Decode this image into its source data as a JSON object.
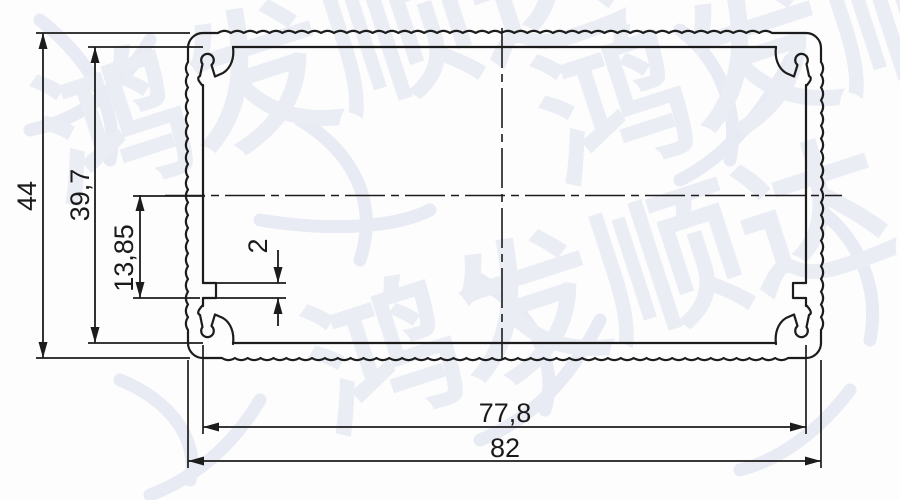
{
  "drawing": {
    "type": "extrusion-profile-cross-section",
    "line_color": "#1c1c1c",
    "background_color": "#fdfdfe"
  },
  "watermark": {
    "text": "鸿发顺达",
    "color": "#eaedf4"
  },
  "dimensions": {
    "outer_height": {
      "label": "44",
      "orientation": "vertical"
    },
    "inner_height": {
      "label": "39,7",
      "orientation": "vertical"
    },
    "slot_offset": {
      "label": "13,85",
      "orientation": "vertical"
    },
    "slot_width": {
      "label": "2",
      "orientation": "vertical"
    },
    "inner_width": {
      "label": "77,8",
      "orientation": "horizontal"
    },
    "outer_width": {
      "label": "82",
      "orientation": "horizontal"
    }
  }
}
